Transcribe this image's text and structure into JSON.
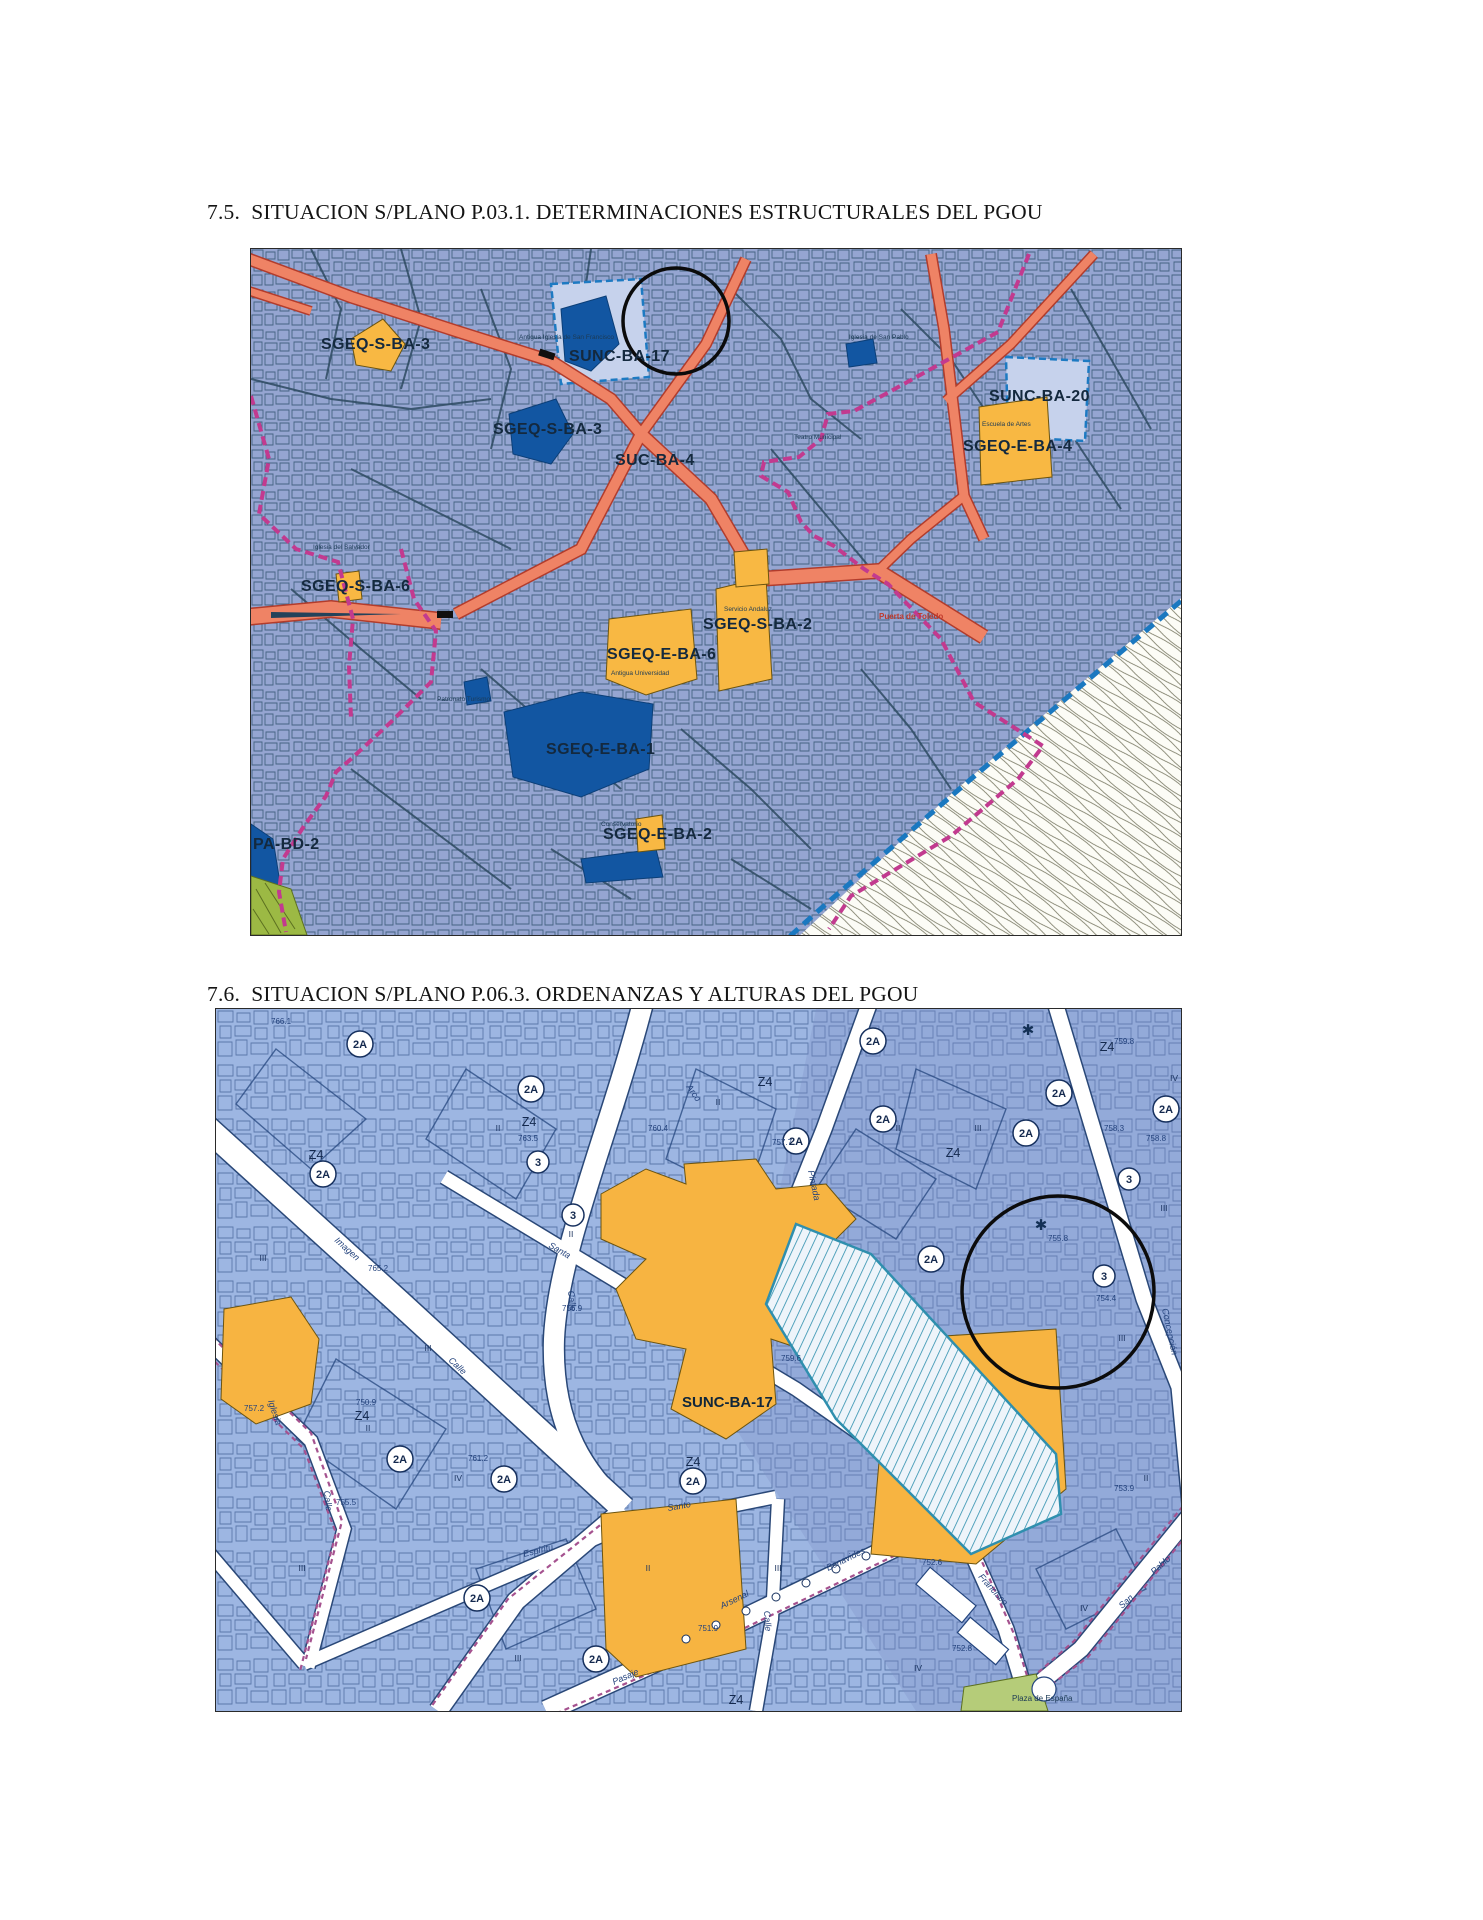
{
  "document": {
    "heading_7_5": "7.5.  SITUACION S/PLANO P.03.1. DETERMINACIONES ESTRUCTURALES DEL PGOU",
    "heading_7_6": "7.6.  SITUACION S/PLANO P.06.3. ORDENANZAS Y ALTURAS DEL PGOU"
  },
  "map1": {
    "zone_labels": {
      "sgeq_s_ba_3_top": "SGEQ-S-BA-3",
      "sunc_ba_17": "SUNC-BA-17",
      "sunc_ba_20": "SUNC-BA-20",
      "sgeq_e_ba_4": "SGEQ-E-BA-4",
      "sgeq_s_ba_3_mid": "SGEQ-S-BA-3",
      "suc_ba_4": "SUC-BA-4",
      "sgeq_s_ba_6": "SGEQ-S-BA-6",
      "sgeq_s_ba_2": "SGEQ-S-BA-2",
      "sgeq_e_ba_6": "SGEQ-E-BA-6",
      "sgeq_e_ba_1": "SGEQ-E-BA-1",
      "sgeq_e_ba_2": "SGEQ-E-BA-2",
      "pa_bd_2": "PA-BD-2"
    },
    "minor_labels": {
      "puerta_toledo": "Puerta de Toledo",
      "iglesia_san_pablo": "Iglesia de San Pablo",
      "iglesia_salvador": "Iglesia del Salvador",
      "antigua_iglesia": "Antigua Iglesia de San Francisco",
      "antigua_universidad": "Antigua Universidad",
      "servicio_andaluz": "Servicio Andaluz",
      "conservatorio": "Conservatorio",
      "patronato": "Patronato Turismo",
      "teatro": "Teatro Municipal",
      "escuela_artes": "Escuela de Artes"
    },
    "colors": {
      "background": "#95a5d1",
      "equipment_blue": "#1256a2",
      "equipment_yellow": "#f8b843",
      "road_salmon": "#ef8365",
      "boundary_magenta": "#c23a8f",
      "coast_blue": "#1a78c0",
      "green_area": "#9cb944"
    }
  },
  "map2": {
    "main_label": "SUNC-BA-17",
    "plaza_label": "Plaza de España",
    "ordinance_2a": "2A",
    "ordinance_3": "3",
    "zone_z4": "Z4",
    "roman_ii": "II",
    "roman_iii": "III",
    "roman_iv": "IV",
    "palm_icon": "✱",
    "elevations": {
      "e1": "766.1",
      "e2": "763.5",
      "e3": "765.2",
      "e4": "760.4",
      "e5": "759.8",
      "e6": "758.8",
      "e7": "761.2",
      "e8": "759.6",
      "e9": "757.7",
      "e10": "758.3",
      "e11": "755.8",
      "e12": "754.4",
      "e13": "753.9",
      "e14": "752.6",
      "e15": "755.5",
      "e16": "751.9",
      "e17": "757.2",
      "e18": "750.9",
      "e19": "756.9",
      "e20": "752.8"
    },
    "streets": {
      "calle": "Calle",
      "imagen": "Imagen",
      "pintada": "Pintada",
      "arco": "Arco",
      "santa": "Santa",
      "espiritu": "Espíritu",
      "santo": "Santo",
      "iglesia": "Iglesia",
      "pasaje": "Pasaje",
      "francisco": "Francisco",
      "san": "San",
      "pablo": "Pablo",
      "concepcion": "Concepción",
      "arsenal": "Arsenal",
      "benavides": "Benavides"
    },
    "colors": {
      "background": "#9db6e2",
      "street_white": "#ffffff",
      "parcel_line": "#24457e",
      "zone_yellow": "#f7b441",
      "hatch_teal": "#2f8fae",
      "boundary_purple": "#a5528f",
      "green_area": "#b5cc79"
    }
  }
}
